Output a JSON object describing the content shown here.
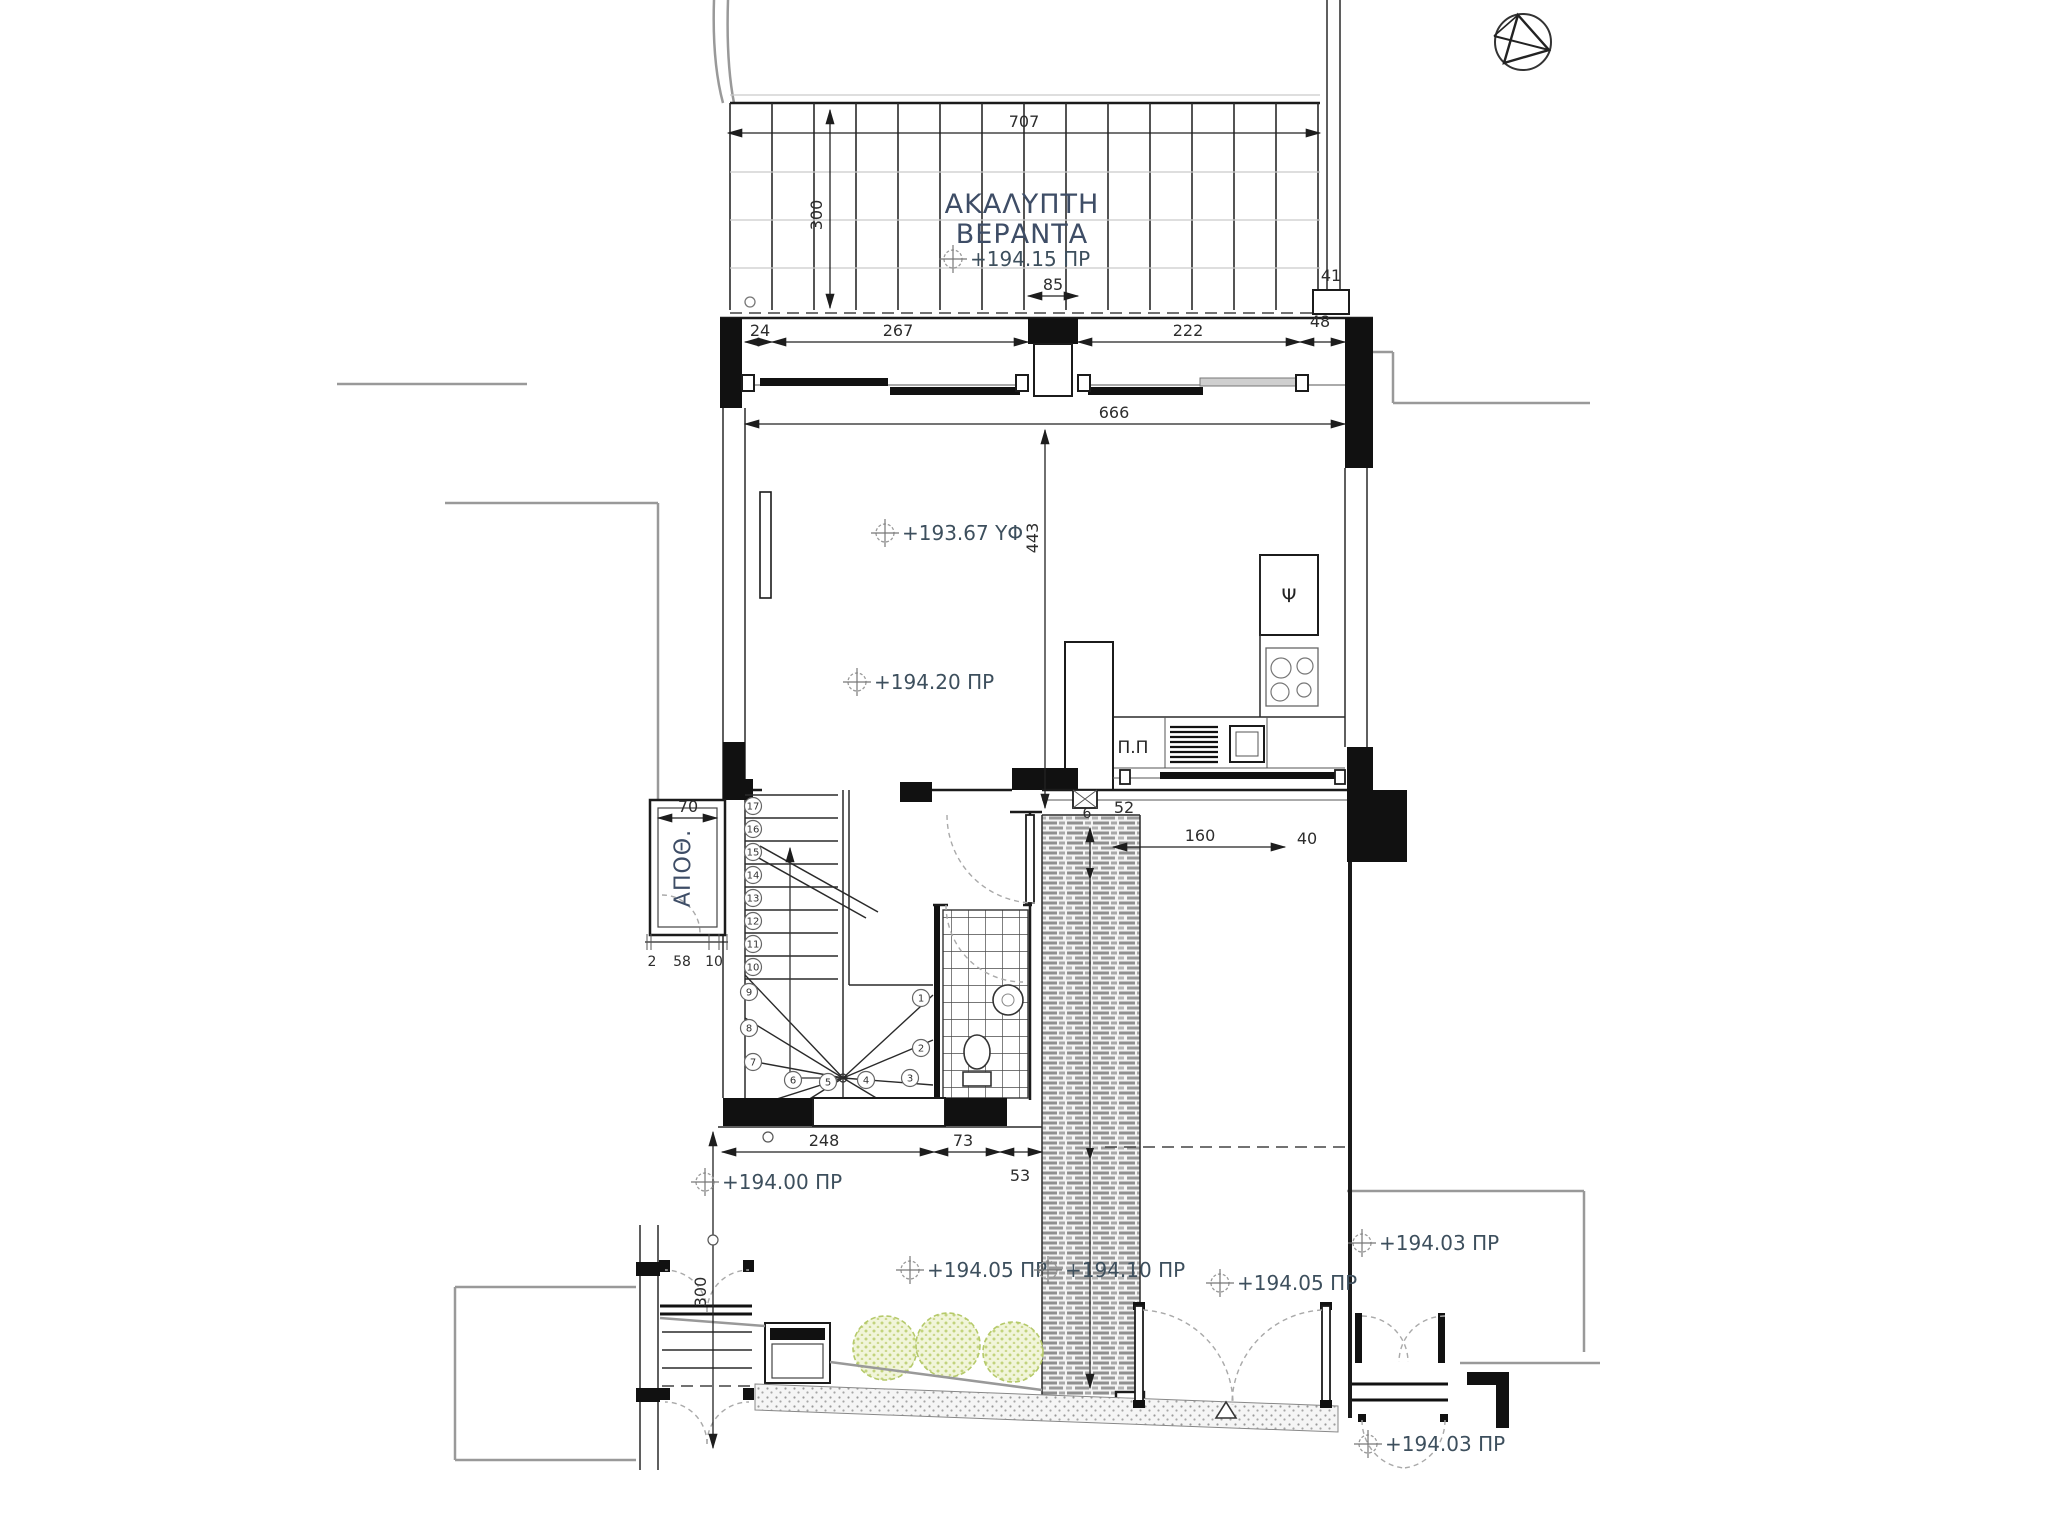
{
  "plan": {
    "veranda_label_line1": "ΑΚΑΛΥΠΤΗ",
    "veranda_label_line2": "ΒΕΡΑΝΤΑ",
    "storage_label": "ΑΠΟΘ.",
    "fridge_label": "Ψ",
    "counter_label": "Π.Π"
  },
  "levels": [
    {
      "id": "veranda",
      "text": "+194.15 ΠΡ"
    },
    {
      "id": "floor-structure",
      "text": "+193.67 ΥΦ"
    },
    {
      "id": "interior",
      "text": "+194.20 ΠΡ"
    },
    {
      "id": "yard-west",
      "text": "+194.00 ΠΡ"
    },
    {
      "id": "garden",
      "text": "+194.05 ΠΡ"
    },
    {
      "id": "walkway",
      "text": "+194.10 ΠΡ"
    },
    {
      "id": "entrance-court",
      "text": "+194.05 ΠΡ"
    },
    {
      "id": "neighbor-upper",
      "text": "+194.03 ΠΡ"
    },
    {
      "id": "neighbor-lower",
      "text": "+194.03 ΠΡ"
    }
  ],
  "dimensions": {
    "top_width": "707",
    "veranda_depth": "300",
    "seg_24": "24",
    "seg_267": "267",
    "door_85": "85",
    "seg_222": "222",
    "seg_48": "48",
    "col_41": "41",
    "interior_width": "666",
    "interior_depth": "443",
    "step_6": "6",
    "step_52": "52",
    "counter_160": "160",
    "counter_40": "40",
    "storage_width": "70",
    "storage_2": "2",
    "storage_58": "58",
    "storage_10": "10",
    "stair_248": "248",
    "wc_73": "73",
    "walk_53": "53",
    "side_yard_300": "300"
  },
  "stairs": {
    "steps_straight": [
      "17",
      "16",
      "15",
      "14",
      "13",
      "12",
      "11",
      "10"
    ],
    "steps_winder": [
      "9",
      "8",
      "7",
      "6",
      "5",
      "4",
      "3",
      "2",
      "1"
    ]
  }
}
